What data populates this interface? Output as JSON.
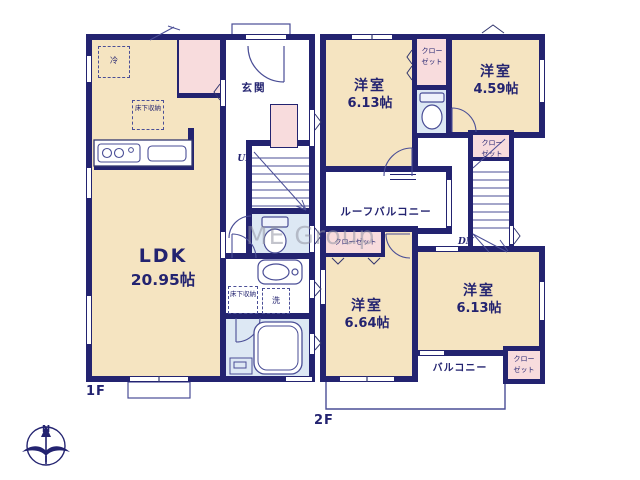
{
  "watermark": "ME Group",
  "compass": {
    "north_label": "N"
  },
  "colors": {
    "wall": "#232370",
    "room_fill": "#f5e4c1",
    "closet_fill": "#f8dcdd",
    "wet_fill": "#dde8f4"
  },
  "floor1": {
    "label": "1F",
    "ldk": {
      "name": "LDK",
      "size": "20.95帖"
    },
    "entrance_label": "玄関",
    "fridge_label": "冷",
    "underfloor_storage_kitchen": "床下収納",
    "underfloor_storage_wash": "床下収納",
    "laundry_label": "洗",
    "stairs_up_label": "UP"
  },
  "floor2": {
    "label": "2F",
    "room_nw": {
      "name": "洋室",
      "size": "6.13帖"
    },
    "room_ne": {
      "name": "洋室",
      "size": "4.59帖"
    },
    "room_sw": {
      "name": "洋室",
      "size": "6.64帖"
    },
    "room_se": {
      "name": "洋室",
      "size": "6.13帖"
    },
    "closet_top": "クローゼット",
    "closet_mid": "クローゼット",
    "closet_sw": "クローゼット",
    "closet_se": "クローゼット",
    "roof_balcony_label": "ルーフバルコニー",
    "balcony_label": "バルコニー",
    "stairs_down_label": "DN"
  }
}
